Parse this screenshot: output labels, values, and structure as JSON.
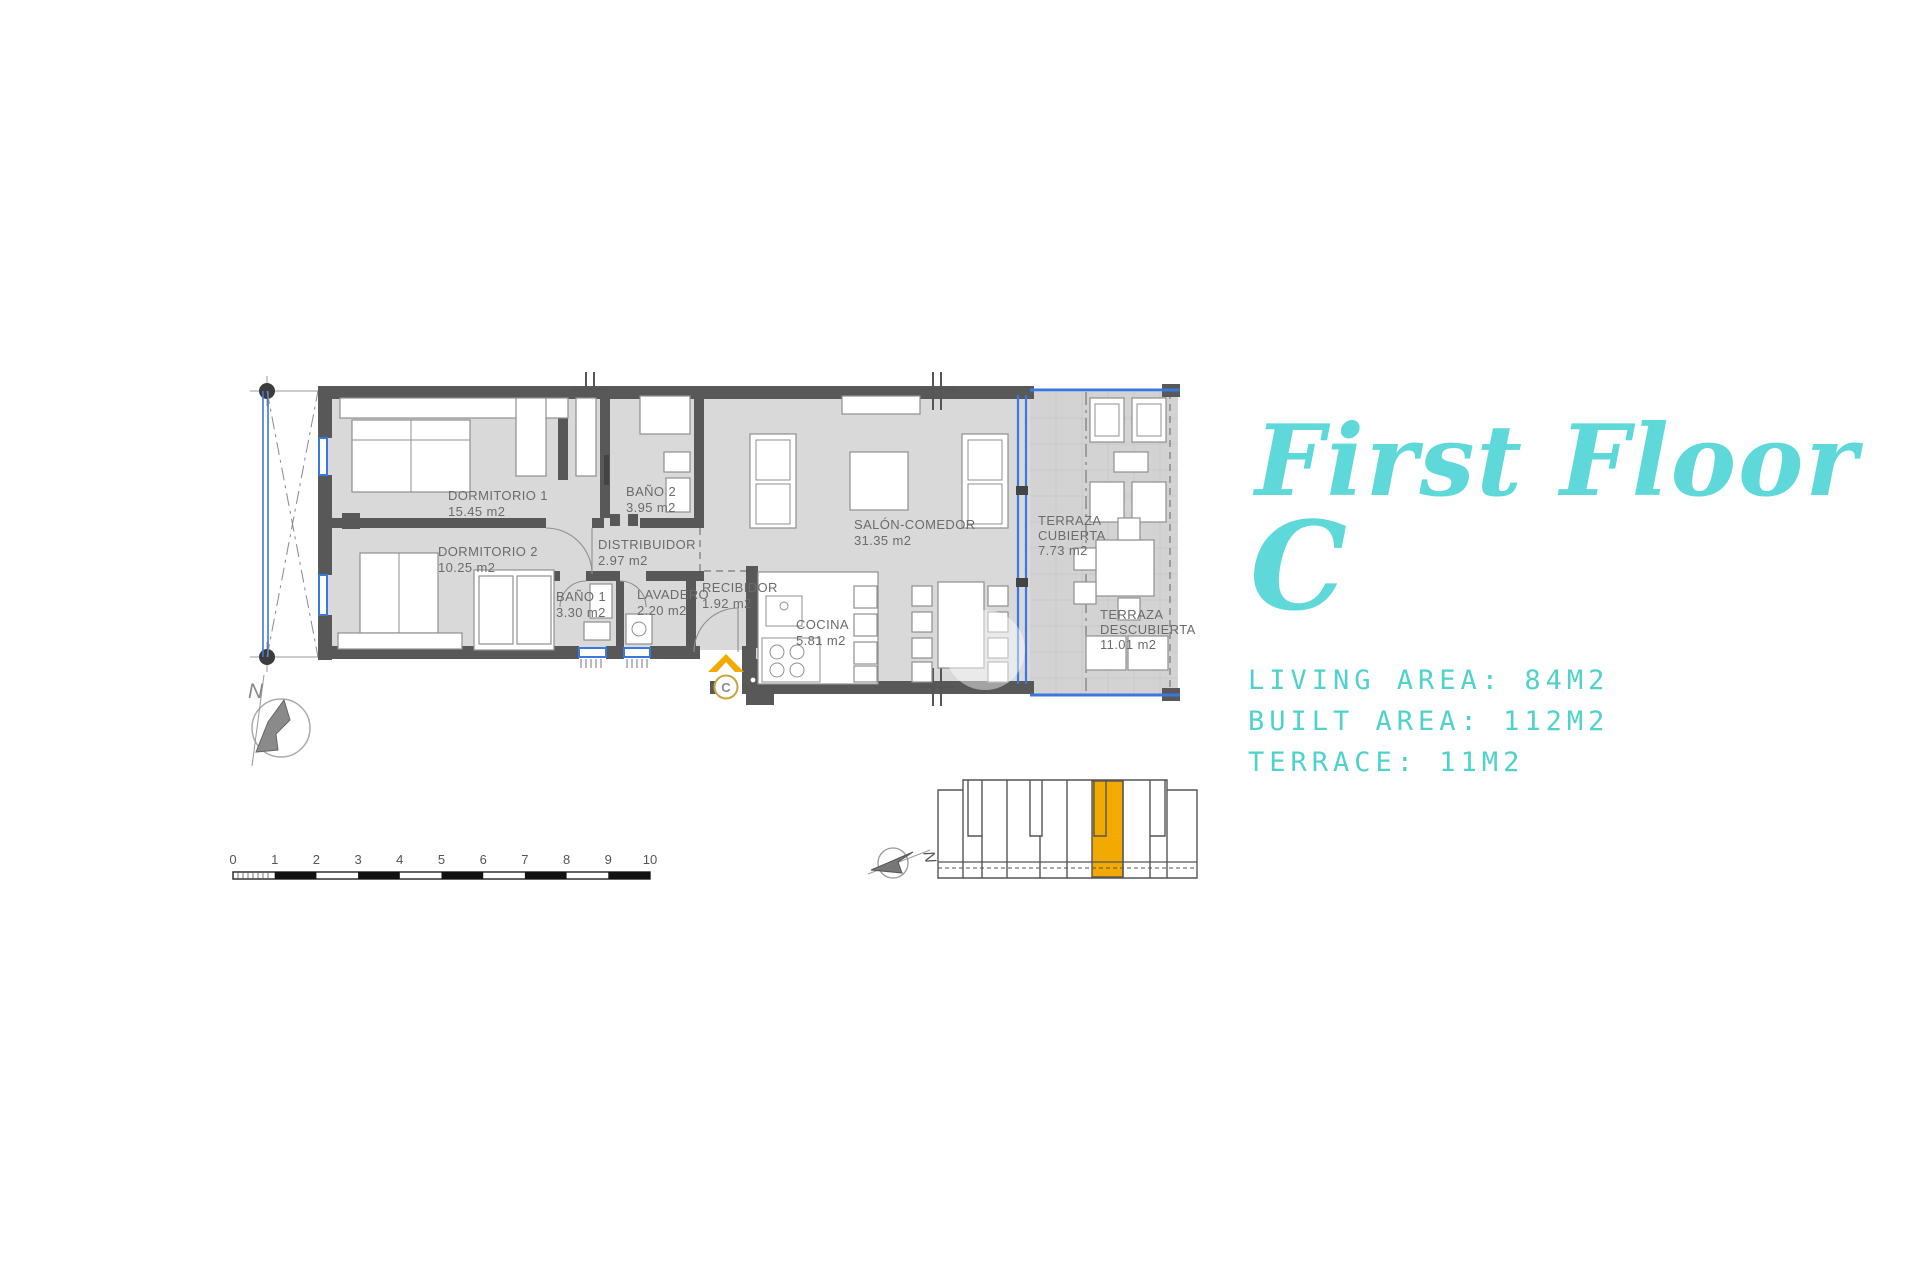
{
  "title": {
    "line1": "First Floor",
    "line2": "C"
  },
  "stats": {
    "living_area": "LIVING AREA: 84M2",
    "built_area": "BUILT AREA: 112M2",
    "terrace": "TERRACE: 11M2"
  },
  "plan": {
    "rooms": [
      {
        "name": "DORMITORIO 1",
        "area": "15.45 m2"
      },
      {
        "name": "DORMITORIO 2",
        "area": "10.25 m2"
      },
      {
        "name": "BAÑO 2",
        "area": "3.95 m2"
      },
      {
        "name": "DISTRIBUIDOR",
        "area": "2.97 m2"
      },
      {
        "name": "BAÑO 1",
        "area": "3.30 m2"
      },
      {
        "name": "LAVADERO",
        "area": "2.20 m2"
      },
      {
        "name": "RECIBIDOR",
        "area": "1.92 m2"
      },
      {
        "name": "COCINA",
        "area": "5.81 m2"
      },
      {
        "name": "SALÓN-COMEDOR",
        "area": "31.35 m2"
      },
      {
        "name_lines": [
          "TERRAZA",
          "CUBIERTA"
        ],
        "area": "7.73 m2"
      },
      {
        "name_lines": [
          "TERRAZA",
          "DESCUBIERTA"
        ],
        "area": "11.01 m2"
      }
    ],
    "entrance_label": "C",
    "north_label": "N"
  },
  "scale_bar": {
    "labels": [
      "0",
      "1",
      "2",
      "3",
      "4",
      "5",
      "6",
      "7",
      "8",
      "9",
      "10"
    ]
  },
  "locator": {
    "north_label": "N"
  },
  "colors": {
    "accent_teal": "#5fd8da",
    "stats_teal": "#4ed2cb",
    "highlight_orange": "#f2a900",
    "window_blue": "#3a78e0",
    "wall_gray": "#585858",
    "floor_gray": "#d9d9d9",
    "terrace_gray": "#d3d3d3",
    "label_gray": "#6b6b6b"
  }
}
